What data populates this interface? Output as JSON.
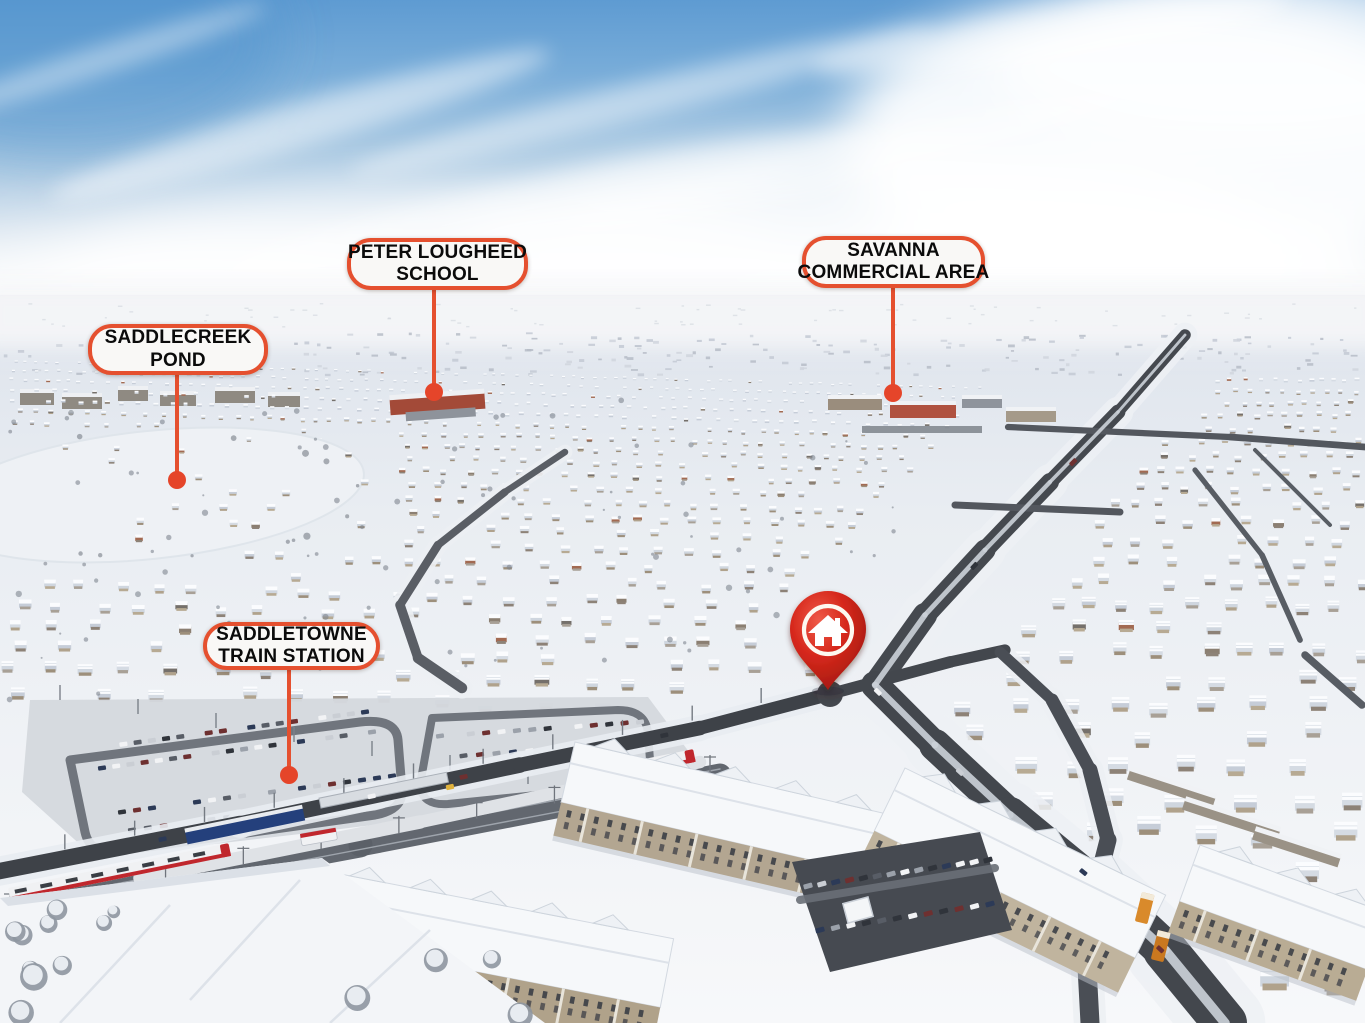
{
  "scene": {
    "description": "Winter aerial drone photograph of a snow-covered suburban neighbourhood with a train station, highway, condo buildings and labelled landmarks",
    "season": "winter",
    "colors": {
      "accent": "#e5502f",
      "leader_dot": "#e5452a",
      "pin_red": "#d6281c",
      "sky_blue": "#5e9bd2",
      "snow_white": "#f6f7f9",
      "asphalt": "#43474d",
      "train_red": "#c0272d",
      "canopy_blue": "#24407c"
    }
  },
  "annotations": {
    "labels": [
      {
        "id": "saddlecreek-pond",
        "lines": [
          "SADDLECREEK",
          "POND"
        ],
        "box": {
          "x": 88,
          "y": 324,
          "w": 180,
          "h": 51
        },
        "leader": {
          "x": 177,
          "y1": 375,
          "y2": 480
        }
      },
      {
        "id": "peter-lougheed-school",
        "lines": [
          "PETER LOUGHEED",
          "SCHOOL"
        ],
        "box": {
          "x": 347,
          "y": 238,
          "w": 181,
          "h": 52
        },
        "leader": {
          "x": 434,
          "y1": 290,
          "y2": 392
        }
      },
      {
        "id": "savanna-commercial-area",
        "lines": [
          "SAVANNA",
          "COMMERCIAL AREA"
        ],
        "box": {
          "x": 802,
          "y": 236,
          "w": 183,
          "h": 52
        },
        "leader": {
          "x": 893,
          "y1": 288,
          "y2": 393
        }
      },
      {
        "id": "saddletowne-train-station",
        "lines": [
          "SADDLETOWNE",
          "TRAIN STATION"
        ],
        "box": {
          "x": 203,
          "y": 622,
          "w": 177,
          "h": 48
        },
        "leader": {
          "x": 289,
          "y1": 670,
          "y2": 775
        }
      }
    ],
    "pin": {
      "icon": "home-icon",
      "x": 828,
      "y": 633,
      "tip_y": 690
    }
  }
}
